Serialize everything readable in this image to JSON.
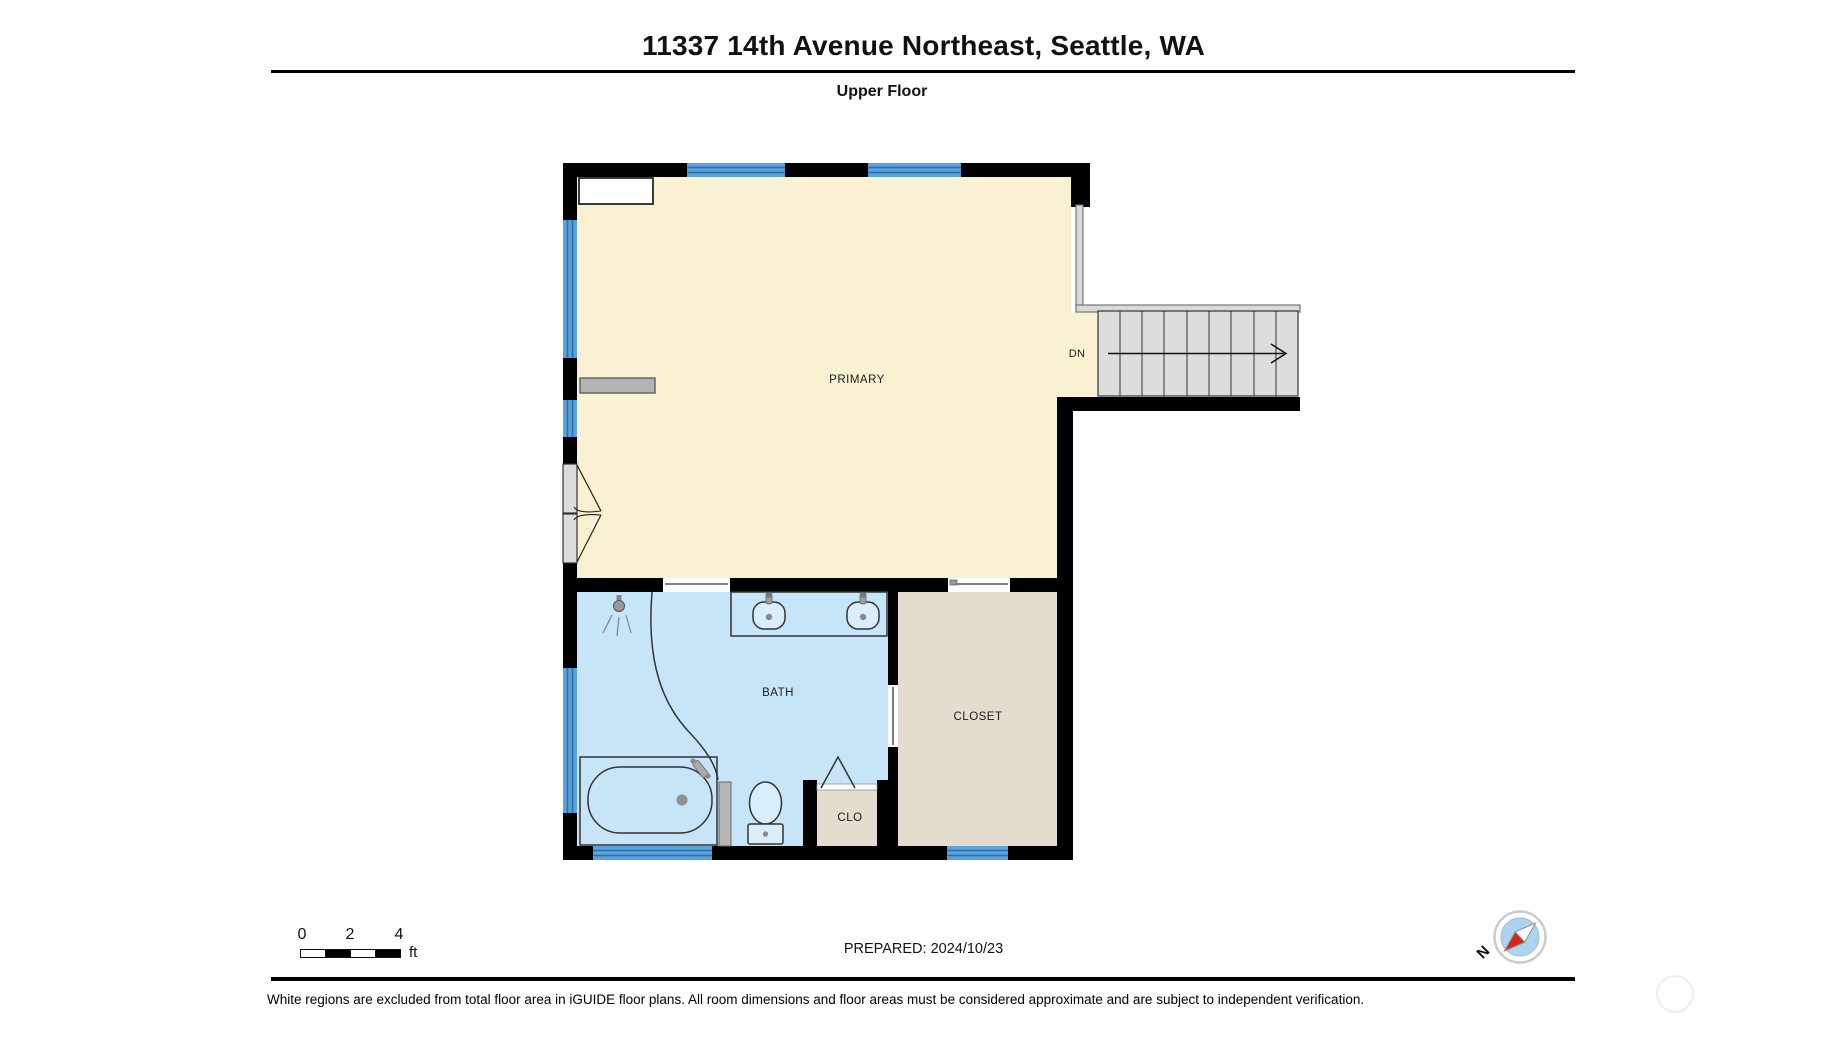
{
  "header": {
    "title": "11337 14th Avenue Northeast, Seattle, WA",
    "floor_label": "Upper Floor"
  },
  "floor_plan": {
    "rooms": [
      {
        "name": "PRIMARY"
      },
      {
        "name": "BATH"
      },
      {
        "name": "CLOSET"
      },
      {
        "name": "CLO"
      }
    ],
    "stairs_label": "DN"
  },
  "footer": {
    "scale_bar": {
      "ticks": [
        "0",
        "2",
        "4"
      ],
      "unit": "ft"
    },
    "prepared_label": "PREPARED: 2024/10/23",
    "compass": {
      "north_label": "N"
    },
    "disclaimer": "White regions are excluded from total floor area in iGUIDE floor plans. All room dimensions and floor areas must be considered approximate and are subject to independent verification."
  },
  "colors": {
    "wall": "#000000",
    "primary_room": "#FAF0D2",
    "bath_room": "#C7E5F8",
    "closet_room": "#E4DCCC",
    "window": "#5AA2DB",
    "window_line": "#2B6DA5",
    "stairs_fill": "#DDDDDD",
    "railing": "#D9D9D9",
    "fixture": "#D8EEFB",
    "compass_blue": "#A9D4F2",
    "compass_red": "#D6271F"
  }
}
